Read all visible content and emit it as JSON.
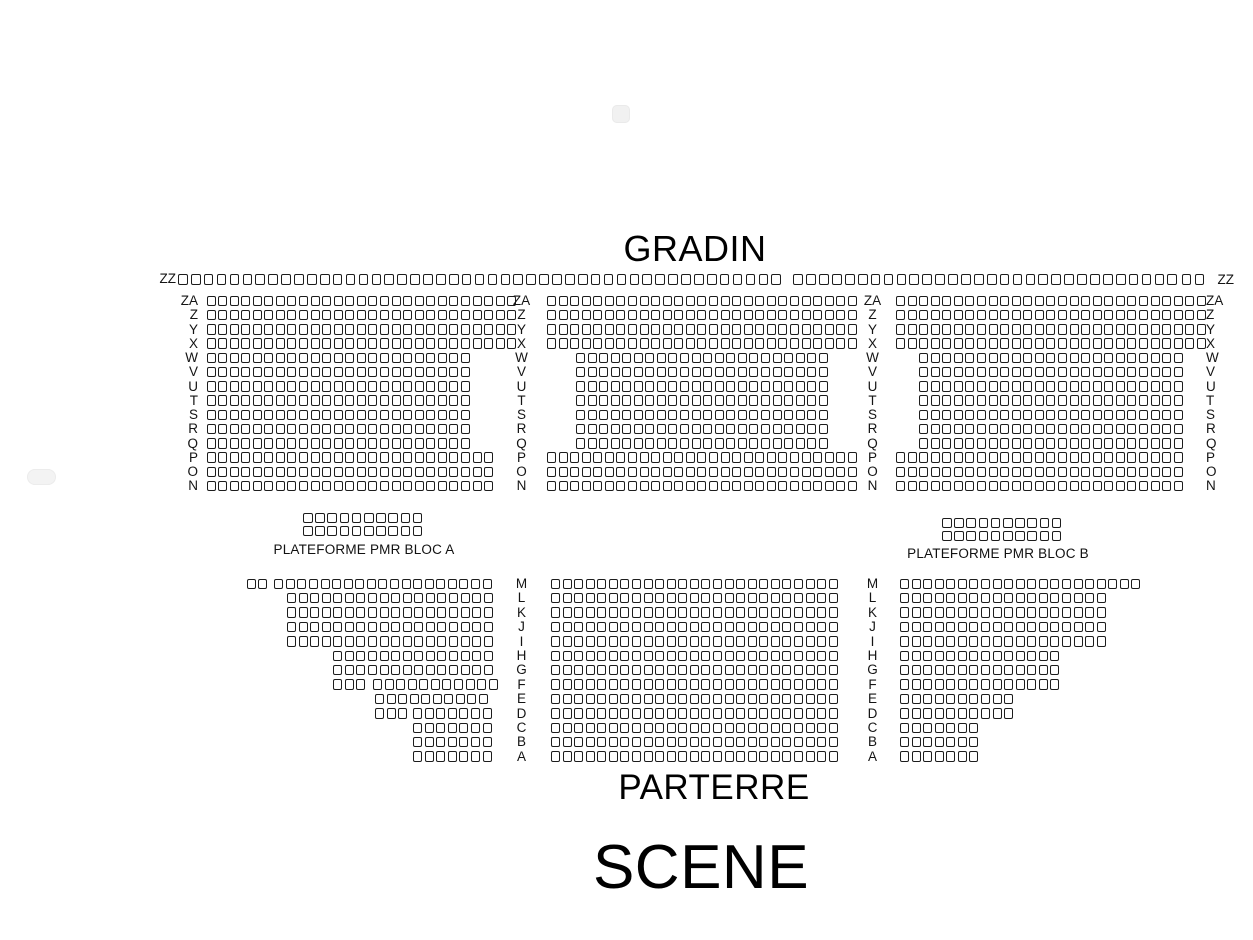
{
  "titles": {
    "gradin": "GRADIN",
    "parterre": "PARTERRE",
    "scene": "SCENE"
  },
  "pmr": {
    "bloc_a": "PLATEFORME PMR BLOC A",
    "bloc_b": "PLATEFORME PMR BLOC B"
  },
  "row_labels": {
    "zz": "ZZ",
    "gradin": [
      "ZA",
      "Z",
      "Y",
      "X",
      "W",
      "V",
      "U",
      "T",
      "S",
      "R",
      "Q",
      "P",
      "O",
      "N"
    ],
    "parterre": [
      "M",
      "L",
      "K",
      "J",
      "I",
      "H",
      "G",
      "F",
      "E",
      "D",
      "C",
      "B",
      "A"
    ]
  },
  "colors": {
    "seat_fill": "#ffffff",
    "seat_border": "#1c1c1c",
    "text": "#111111",
    "background": "#ffffff"
  },
  "seatmap": {
    "defaults": {
      "seat_w": 9,
      "seat_h": 10.5,
      "pitch_x": 11.57,
      "pitch_y": 14.25
    },
    "blocks": [
      {
        "name": "gradin-zz-row",
        "x0": 178,
        "y0": 274,
        "pitch_x": 12.9,
        "seat_w": 9.7,
        "rows": [
          {
            "label": "ZZ",
            "segs": [
              [
                0,
                47
              ],
              [
                47.7,
                30
              ],
              [
                77.8,
                2
              ]
            ]
          }
        ]
      },
      {
        "name": "gradin-left-block",
        "x0": 206.5,
        "y0": 295.5,
        "rows": [
          {
            "label": "ZA",
            "segs": [
              [
                0,
                27
              ]
            ]
          },
          {
            "label": "Z",
            "segs": [
              [
                0,
                27
              ]
            ]
          },
          {
            "label": "Y",
            "segs": [
              [
                0,
                27
              ]
            ]
          },
          {
            "label": "X",
            "segs": [
              [
                0,
                27
              ]
            ]
          },
          {
            "label": "W",
            "segs": [
              [
                0,
                23
              ]
            ]
          },
          {
            "label": "V",
            "segs": [
              [
                0,
                23
              ]
            ]
          },
          {
            "label": "U",
            "segs": [
              [
                0,
                23
              ]
            ]
          },
          {
            "label": "T",
            "segs": [
              [
                0,
                23
              ]
            ]
          },
          {
            "label": "S",
            "segs": [
              [
                0,
                23
              ]
            ]
          },
          {
            "label": "R",
            "segs": [
              [
                0,
                23
              ]
            ]
          },
          {
            "label": "Q",
            "segs": [
              [
                0,
                23
              ]
            ]
          },
          {
            "label": "P",
            "segs": [
              [
                0,
                25
              ]
            ]
          },
          {
            "label": "O",
            "segs": [
              [
                0,
                25
              ]
            ]
          },
          {
            "label": "N",
            "segs": [
              [
                0,
                25
              ]
            ]
          }
        ]
      },
      {
        "name": "gradin-center-block",
        "x0": 547,
        "y0": 295.5,
        "rows": [
          {
            "label": "ZA",
            "segs": [
              [
                0,
                27
              ]
            ]
          },
          {
            "label": "Z",
            "segs": [
              [
                0,
                27
              ]
            ]
          },
          {
            "label": "Y",
            "segs": [
              [
                0,
                27
              ]
            ]
          },
          {
            "label": "X",
            "segs": [
              [
                0,
                27
              ]
            ]
          },
          {
            "label": "W",
            "segs": [
              [
                2.5,
                22
              ]
            ]
          },
          {
            "label": "V",
            "segs": [
              [
                2.5,
                22
              ]
            ]
          },
          {
            "label": "U",
            "segs": [
              [
                2.5,
                22
              ]
            ]
          },
          {
            "label": "T",
            "segs": [
              [
                2.5,
                22
              ]
            ]
          },
          {
            "label": "S",
            "segs": [
              [
                2.5,
                22
              ]
            ]
          },
          {
            "label": "R",
            "segs": [
              [
                2.5,
                22
              ]
            ]
          },
          {
            "label": "Q",
            "segs": [
              [
                2.5,
                22
              ]
            ]
          },
          {
            "label": "P",
            "segs": [
              [
                0,
                27
              ]
            ]
          },
          {
            "label": "O",
            "segs": [
              [
                0,
                27
              ]
            ]
          },
          {
            "label": "N",
            "segs": [
              [
                0,
                27
              ]
            ]
          }
        ]
      },
      {
        "name": "gradin-right-block",
        "x0": 896,
        "y0": 295.5,
        "rows": [
          {
            "label": "ZA",
            "segs": [
              [
                0,
                27
              ]
            ]
          },
          {
            "label": "Z",
            "segs": [
              [
                0,
                27
              ]
            ]
          },
          {
            "label": "Y",
            "segs": [
              [
                0,
                27
              ]
            ]
          },
          {
            "label": "X",
            "segs": [
              [
                0,
                27
              ]
            ]
          },
          {
            "label": "W",
            "segs": [
              [
                2,
                23
              ]
            ]
          },
          {
            "label": "V",
            "segs": [
              [
                2,
                23
              ]
            ]
          },
          {
            "label": "U",
            "segs": [
              [
                2,
                23
              ]
            ]
          },
          {
            "label": "T",
            "segs": [
              [
                2,
                23
              ]
            ]
          },
          {
            "label": "S",
            "segs": [
              [
                2,
                23
              ]
            ]
          },
          {
            "label": "R",
            "segs": [
              [
                2,
                23
              ]
            ]
          },
          {
            "label": "Q",
            "segs": [
              [
                2,
                23
              ]
            ]
          },
          {
            "label": "P",
            "segs": [
              [
                0,
                25
              ]
            ]
          },
          {
            "label": "O",
            "segs": [
              [
                0,
                25
              ]
            ]
          },
          {
            "label": "N",
            "segs": [
              [
                0,
                25
              ]
            ]
          }
        ]
      },
      {
        "name": "pmr-bloc-a",
        "x0": 303,
        "y0": 513,
        "pitch_x": 12.2,
        "pitch_y": 13,
        "seat_w": 9.5,
        "seat_h": 10,
        "rows": [
          {
            "label": "PMR-A1",
            "segs": [
              [
                0,
                10
              ]
            ]
          },
          {
            "label": "PMR-A2",
            "segs": [
              [
                0,
                10
              ]
            ]
          }
        ]
      },
      {
        "name": "pmr-bloc-b",
        "x0": 942,
        "y0": 517.5,
        "pitch_x": 12.2,
        "pitch_y": 13,
        "seat_w": 9.5,
        "seat_h": 10,
        "rows": [
          {
            "label": "PMR-B1",
            "segs": [
              [
                0,
                10
              ]
            ]
          },
          {
            "label": "PMR-B2",
            "segs": [
              [
                0,
                10
              ]
            ]
          }
        ]
      },
      {
        "name": "parterre-left-block",
        "x0": 246.5,
        "y0": 578.5,
        "pitch_y": 14.4,
        "rows": [
          {
            "label": "M",
            "segs": [
              [
                0,
                2
              ],
              [
                2.4,
                19
              ]
            ]
          },
          {
            "label": "L",
            "segs": [
              [
                3.5,
                18
              ]
            ]
          },
          {
            "label": "K",
            "segs": [
              [
                3.5,
                18
              ]
            ]
          },
          {
            "label": "J",
            "segs": [
              [
                3.5,
                18
              ]
            ]
          },
          {
            "label": "I",
            "segs": [
              [
                3.5,
                18
              ]
            ]
          },
          {
            "label": "H",
            "segs": [
              [
                7.5,
                14
              ]
            ]
          },
          {
            "label": "G",
            "segs": [
              [
                7.5,
                14
              ]
            ]
          },
          {
            "label": "F",
            "segs": [
              [
                7.5,
                3
              ],
              [
                10.93,
                11
              ]
            ]
          },
          {
            "label": "E",
            "segs": [
              [
                11.1,
                10
              ]
            ]
          },
          {
            "label": "D",
            "segs": [
              [
                11.1,
                3
              ],
              [
                14.4,
                7
              ]
            ]
          },
          {
            "label": "C",
            "segs": [
              [
                14.4,
                7
              ]
            ]
          },
          {
            "label": "B",
            "segs": [
              [
                14.4,
                7
              ]
            ]
          },
          {
            "label": "A",
            "segs": [
              [
                14.4,
                7
              ]
            ]
          }
        ]
      },
      {
        "name": "parterre-center-block",
        "x0": 551,
        "y0": 578.5,
        "pitch_y": 14.4,
        "rows": [
          {
            "label": "M",
            "segs": [
              [
                0,
                25
              ]
            ]
          },
          {
            "label": "L",
            "segs": [
              [
                0,
                25
              ]
            ]
          },
          {
            "label": "K",
            "segs": [
              [
                0,
                25
              ]
            ]
          },
          {
            "label": "J",
            "segs": [
              [
                0,
                25
              ]
            ]
          },
          {
            "label": "I",
            "segs": [
              [
                0,
                25
              ]
            ]
          },
          {
            "label": "H",
            "segs": [
              [
                0,
                25
              ]
            ]
          },
          {
            "label": "G",
            "segs": [
              [
                0,
                25
              ]
            ]
          },
          {
            "label": "F",
            "segs": [
              [
                0,
                25
              ]
            ]
          },
          {
            "label": "E",
            "segs": [
              [
                0,
                25
              ]
            ]
          },
          {
            "label": "D",
            "segs": [
              [
                0,
                25
              ]
            ]
          },
          {
            "label": "C",
            "segs": [
              [
                0,
                25
              ]
            ]
          },
          {
            "label": "B",
            "segs": [
              [
                0,
                25
              ]
            ]
          },
          {
            "label": "A",
            "segs": [
              [
                0,
                25
              ]
            ]
          }
        ]
      },
      {
        "name": "parterre-right-block",
        "x0": 900,
        "y0": 578.5,
        "pitch_y": 14.4,
        "rows": [
          {
            "label": "M",
            "segs": [
              [
                0,
                21
              ]
            ]
          },
          {
            "label": "L",
            "segs": [
              [
                0,
                18
              ]
            ]
          },
          {
            "label": "K",
            "segs": [
              [
                0,
                18
              ]
            ]
          },
          {
            "label": "J",
            "segs": [
              [
                0,
                18
              ]
            ]
          },
          {
            "label": "I",
            "segs": [
              [
                0,
                18
              ]
            ]
          },
          {
            "label": "H",
            "segs": [
              [
                0,
                14
              ]
            ]
          },
          {
            "label": "G",
            "segs": [
              [
                0,
                14
              ]
            ]
          },
          {
            "label": "F",
            "segs": [
              [
                0,
                14
              ]
            ]
          },
          {
            "label": "E",
            "segs": [
              [
                0,
                10
              ]
            ]
          },
          {
            "label": "D",
            "segs": [
              [
                0,
                10
              ]
            ]
          },
          {
            "label": "C",
            "segs": [
              [
                0,
                7
              ]
            ]
          },
          {
            "label": "B",
            "segs": [
              [
                0,
                7
              ]
            ]
          },
          {
            "label": "A",
            "segs": [
              [
                0,
                7
              ]
            ]
          }
        ]
      },
      {
        "name": "artifact-pills",
        "x0": 0,
        "y0": 0,
        "rows": []
      }
    ],
    "label_columns": [
      {
        "name": "gradin-far-left-labels",
        "x": 198,
        "align": "right",
        "y0": 295.5,
        "pitch_y": 14.25,
        "labels": "gradin"
      },
      {
        "name": "gradin-mid-left-labels",
        "x": 521.5,
        "align": "center",
        "y0": 295.5,
        "pitch_y": 14.25,
        "labels": "gradin"
      },
      {
        "name": "gradin-mid-right-labels",
        "x": 872.5,
        "align": "center",
        "y0": 295.5,
        "pitch_y": 14.25,
        "labels": "gradin"
      },
      {
        "name": "gradin-far-right-labels",
        "x": 1206,
        "align": "left",
        "y0": 295.5,
        "pitch_y": 14.25,
        "labels": "gradin"
      },
      {
        "name": "parterre-mid-left-labels",
        "x": 521.5,
        "align": "center",
        "y0": 578.5,
        "pitch_y": 14.4,
        "labels": "parterre"
      },
      {
        "name": "parterre-mid-right-labels",
        "x": 872.5,
        "align": "center",
        "y0": 578.5,
        "pitch_y": 14.4,
        "labels": "parterre"
      }
    ],
    "zz_labels": [
      {
        "name": "zz-label-left",
        "x": 176,
        "y": 273.5,
        "align": "right"
      },
      {
        "name": "zz-label-right",
        "x": 1217.5,
        "y": 274.5,
        "align": "left"
      }
    ]
  }
}
